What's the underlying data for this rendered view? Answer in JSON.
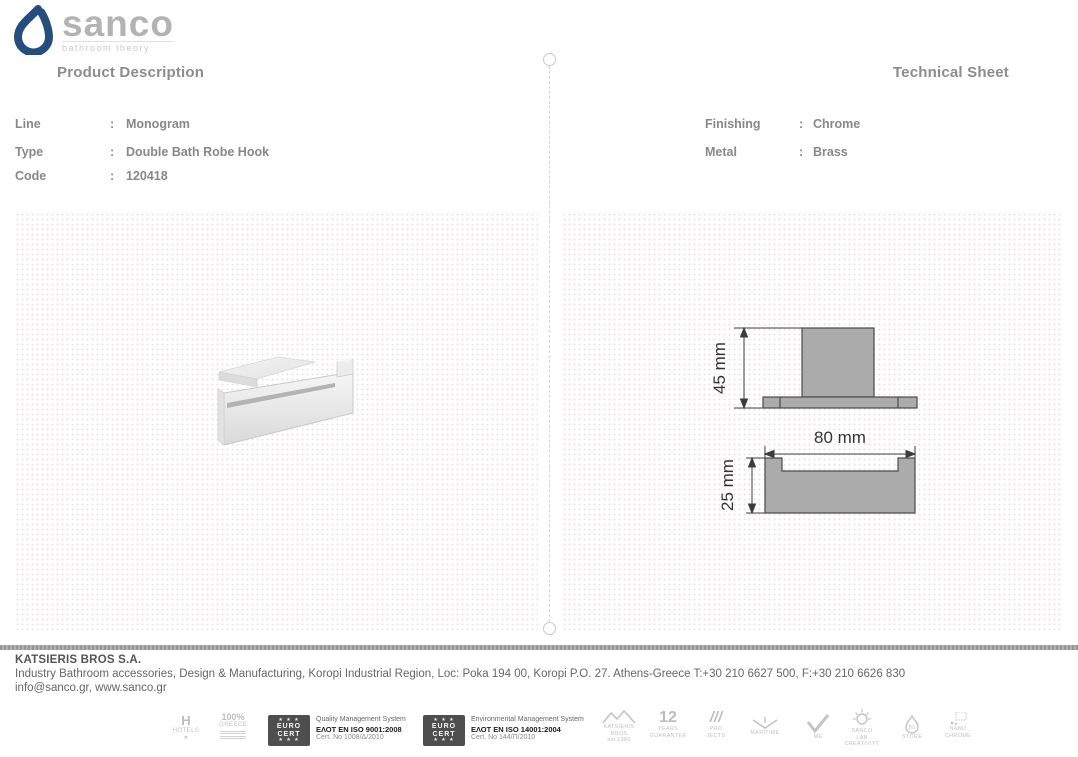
{
  "brand": {
    "name": "sanco",
    "tagline": "bathroom theory"
  },
  "ui": {
    "colon": ":"
  },
  "sections": {
    "product": {
      "title": "Product Description",
      "fields": [
        {
          "label": "Line",
          "value": "Monogram"
        },
        {
          "label": "Type",
          "value": "Double Bath Robe Hook"
        },
        {
          "label": "Code",
          "value": "120418"
        }
      ]
    },
    "technical": {
      "title": "Technical Sheet",
      "fields": [
        {
          "label": "Finishing",
          "value": "Chrome"
        },
        {
          "label": "Metal",
          "value": "Brass"
        }
      ]
    }
  },
  "drawings": {
    "side_view": {
      "height_label": "45 mm"
    },
    "front_view": {
      "width_label": "80 mm",
      "height_label": "25 mm"
    },
    "fill_color": "#ababab",
    "line_color": "#4a4a4a"
  },
  "footer": {
    "company": "KATSIERIS BROS S.A.",
    "address": "Industry Bathroom accessories, Design & Manufacturing, Koropi Industrial Region, Loc: Poka 194 00, Koropi P.O. 27. Athens-Greece  T:+30 210 6627 500, F:+30 210 6626 830",
    "contacts": "info@sanco.gr, www.sanco.gr"
  },
  "certifications": {
    "hotels": {
      "glyph": "H",
      "label": "HOTELS",
      "star": "★"
    },
    "greece": {
      "line1": "100%",
      "line2": "GREECE"
    },
    "eurocert_badge": {
      "stars": "★ ★ ★",
      "line1": "EURO",
      "line2": "CERT"
    },
    "quality": {
      "line1": "Quality Management System",
      "line2": "ΕΛΟΤ EN ISO 9001:2008",
      "line3": "Cert. No 1008/Δ/2010"
    },
    "environmental": {
      "line1": "Environmental Management System",
      "line2": "ΕΛΟΤ EN ISO 14001:2004",
      "line3": "Cert. No 144/Π/2010"
    },
    "katsieris": {
      "line1": "KATSIERIS",
      "line2": "BROS",
      "line3": "est.1980"
    },
    "guarantee": {
      "number": "12",
      "line1": "YEARS",
      "line2": "GUARANTEE"
    },
    "projects": {
      "glyph": "///",
      "line1": "PRO",
      "line2": "JECTS"
    },
    "maritime": {
      "label": "MARITIME"
    },
    "made": {
      "label": "ME"
    },
    "sanco_lab": {
      "line1": "SANCO",
      "line2": "LAB",
      "line3": "CREATIVITY"
    },
    "store": {
      "line1": "BS",
      "line2": "STORE"
    },
    "nano": {
      "line1": "NANO",
      "line2": "CHROME"
    }
  },
  "colors": {
    "brand_blue": "#254e7c",
    "heading_gray": "#8c8c8c",
    "text_gray": "#888888"
  }
}
